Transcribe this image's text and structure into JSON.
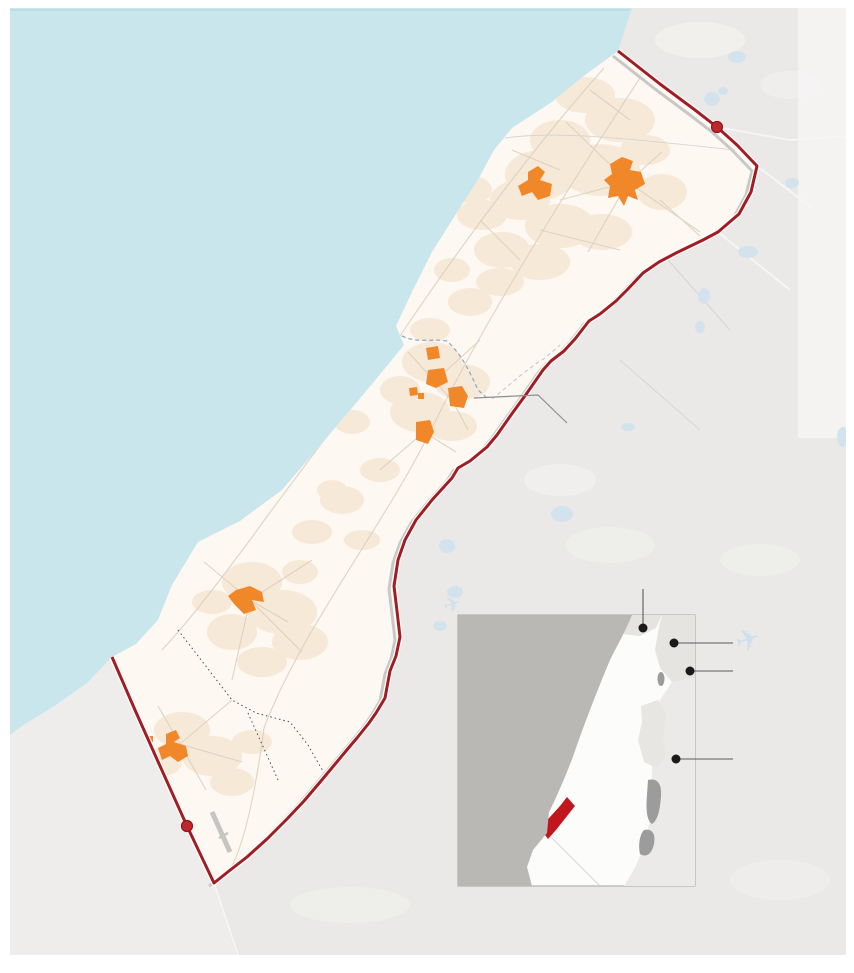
{
  "page": {
    "width": 854,
    "height": 973,
    "background": "#ffffff",
    "kind": "static map graphic of the Gaza Strip with regional locator inset",
    "visible_text": []
  },
  "colors": {
    "sea": "#c8e6ec",
    "sea_edge": "#b7d9e0",
    "land_israel": "#eae9e7",
    "land_israel_light": "#f6f5f3",
    "land_egypt": "#eeedeb",
    "gaza_fill": "#fdf8f1",
    "urban_texture": "#f5e0ca",
    "urban_orange": "#f0882a",
    "border_red": "#a11d23",
    "border_casing": "#ffffff",
    "buffer_gray": "#c9c8c6",
    "crossing_fill": "#c0272d",
    "crossing_stroke": "#8c161c",
    "road": "#dccfbf",
    "road_faint": "#d6d5d3",
    "road_israel": "#f7f6f4",
    "wadi": "#8fadc8",
    "dotted_boundary": "#4a4a4a",
    "pond": "#d3e3ee",
    "airplane": "#cfe0ec",
    "runway": "#c6c5c4",
    "leader": "#8f8f8f",
    "inset_frame": "#a6a5a3",
    "inset_bg": "#fcfcfb",
    "inset_sea": "#b9b8b5",
    "inset_neighbor": "#e5e4e1",
    "inset_jordan": "#ebeae8",
    "inset_westbank": "#e7e6e3",
    "inset_water": "#9c9c9c",
    "inset_gaza": "#c2161f",
    "inset_line": "#d8d7d5",
    "callout_dot": "#1a1a1a",
    "callout_line": "#5a5a5a"
  },
  "icons": {
    "airplane": "✈"
  },
  "markers": {
    "crossings": [
      {
        "name": "border-crossing-north",
        "x": 717,
        "y": 127
      },
      {
        "name": "border-crossing-south",
        "x": 187,
        "y": 826
      }
    ],
    "callouts": [
      {
        "name": "inset-callout-1",
        "x": 643,
        "y": 628
      },
      {
        "name": "inset-callout-2",
        "x": 674,
        "y": 643
      },
      {
        "name": "inset-callout-3",
        "x": 690,
        "y": 671
      },
      {
        "name": "inset-callout-4",
        "x": 676,
        "y": 759
      }
    ],
    "urban_areas": [
      {
        "x": 538,
        "y": 184
      },
      {
        "x": 626,
        "y": 181
      },
      {
        "x": 432,
        "y": 353
      },
      {
        "x": 437,
        "y": 378
      },
      {
        "x": 413,
        "y": 391
      },
      {
        "x": 458,
        "y": 397
      },
      {
        "x": 424,
        "y": 432
      },
      {
        "x": 247,
        "y": 600
      },
      {
        "x": 174,
        "y": 746
      }
    ]
  },
  "inset": {
    "x": 458,
    "y": 615,
    "width": 237,
    "height": 271
  }
}
